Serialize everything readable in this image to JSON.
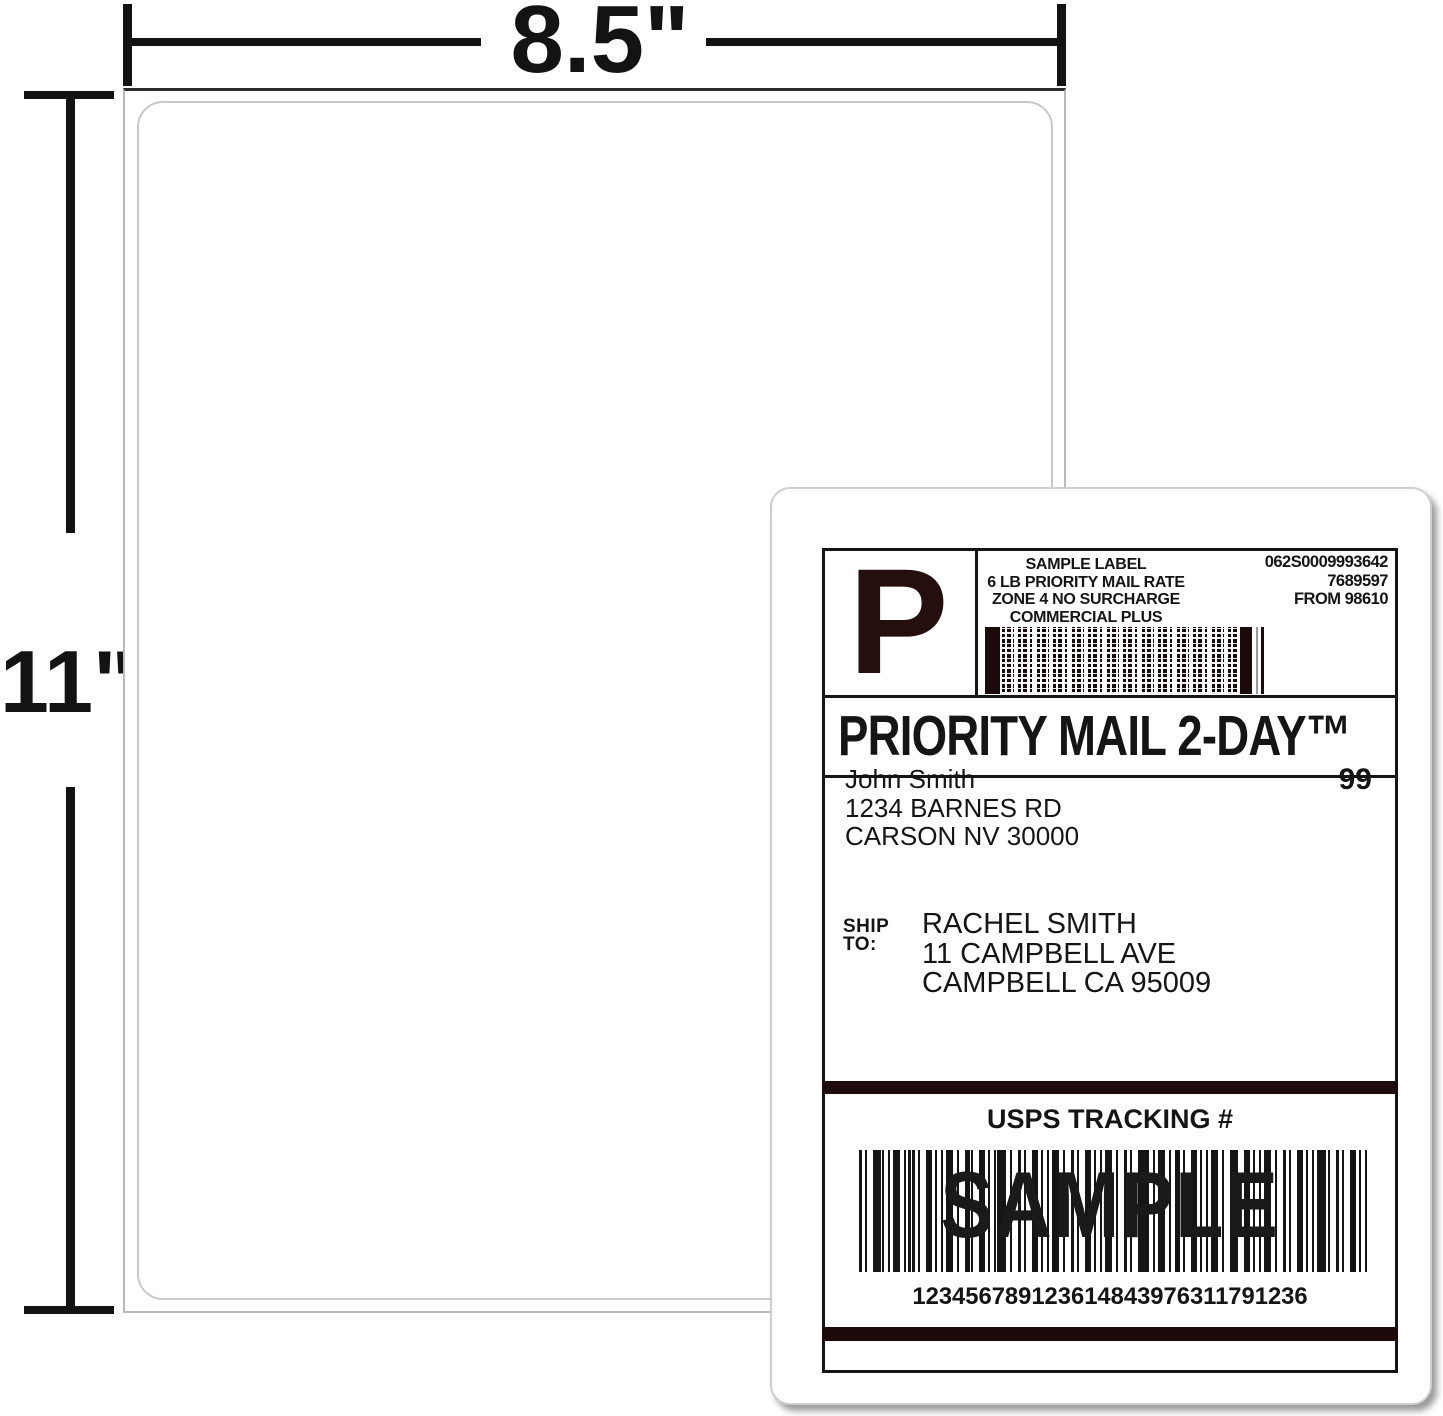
{
  "dimensions": {
    "sheet_width": "8.5\"",
    "printable_width": "8.27\"",
    "sheet_height": "11\""
  },
  "label": {
    "header": {
      "service_indicator": "P",
      "info_lines": [
        "SAMPLE LABEL",
        "6 LB PRIORITY MAIL RATE",
        "ZONE 4 NO SURCHARGE",
        "COMMERCIAL PLUS PRICING"
      ],
      "meta_lines": [
        "062S0009993642",
        "7689597",
        "FROM 98610"
      ]
    },
    "service_title": "PRIORITY MAIL 2-DAY™",
    "sender": {
      "name": "John Smith",
      "street": "1234 BARNES RD",
      "city": "CARSON NV 30000",
      "zone": "99"
    },
    "ship_to": {
      "label_line1": "SHIP",
      "label_line2": "TO:",
      "name": "RACHEL SMITH",
      "street": "11 CAMPBELL AVE",
      "city": "CAMPBELL CA 95009"
    },
    "tracking": {
      "title": "USPS TRACKING #",
      "watermark": "SAMPLE",
      "number": "123456789123614843976311791236"
    }
  },
  "colors": {
    "ink": "#151515",
    "dark_maroon": "#240e0e",
    "sheet_border": "#b9b9b9",
    "card_border": "#cfcfcf"
  }
}
